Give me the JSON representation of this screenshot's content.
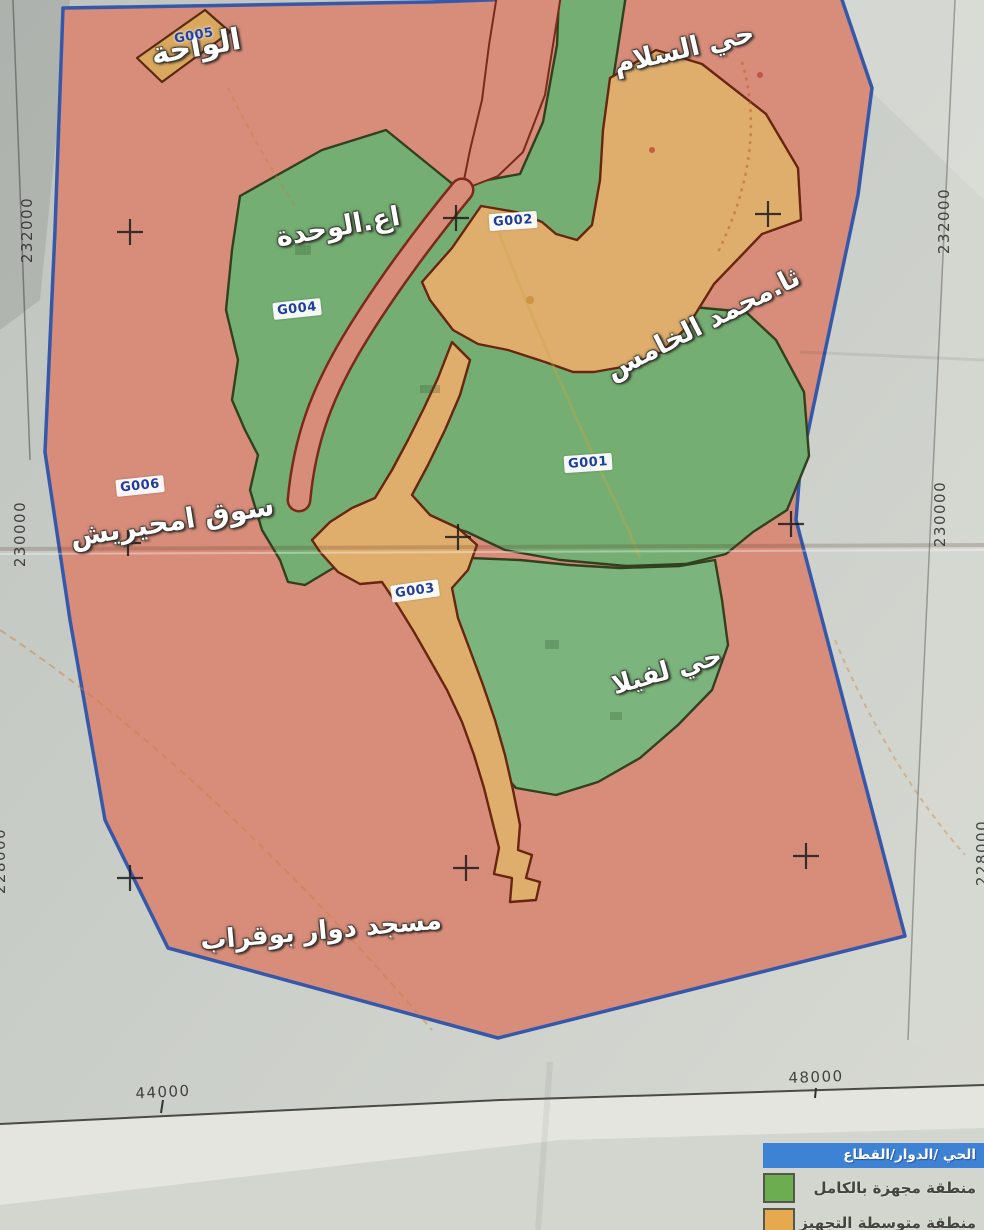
{
  "colors": {
    "paper": "#c6cac4",
    "zone_fully_equipped_green": "#74ae72",
    "zone_medium_equipped_orange": "#dfae6d",
    "zone_background_pink": "#d78d7a",
    "map_boundary_blue": "#3558ab",
    "zone_border_maroon": "#68250f",
    "legend_header_blue": "#3e82d6",
    "legend_green": "#6cae4f",
    "legend_orange": "#e6a94d",
    "zone_code_text_blue": "#1d3e9e"
  },
  "labels": {
    "alwaha": "الواحة",
    "hay_alsalam": "حي السلام",
    "aa_alwahda": "اع.الوحدة",
    "tha_mohamed_alkhamis": "ثا.محمد الخامس",
    "souk_amhirich": "سوق امحيريش",
    "hay_lavilla": "حي لفيلا",
    "masjid_douar_bouqrab": "مسجد دوار بوقراب"
  },
  "zone_codes": {
    "g001": "G001",
    "g002": "G002",
    "g003": "G003",
    "g004": "G004",
    "g005": "G005",
    "g006": "G006"
  },
  "grid": {
    "left": [
      "232000",
      "230000",
      "228000"
    ],
    "right": [
      "232000",
      "230000",
      "228000"
    ],
    "bottom": [
      "44000",
      "48000"
    ]
  },
  "legend": {
    "title": "الحي /الدوار/القطاع",
    "items": [
      {
        "label": "منطقة مجهزة بالكامل",
        "color": "#6cae4f"
      },
      {
        "label": "منطقة متوسطة التجهيز",
        "color": "#e6a94d"
      }
    ]
  }
}
